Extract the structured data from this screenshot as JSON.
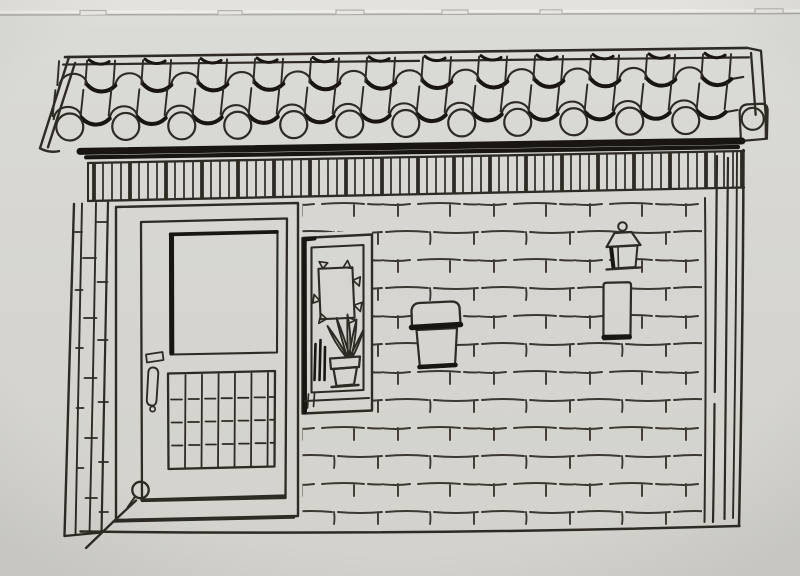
{
  "meta": {
    "type": "photograph of a hand-drawn ink sketch",
    "alt": "Black fineliner drawing on gray paper showing a small single-storey brick shopfront: a wavy pan-and-cover tile roof with round eave tile ends, a slatted fascia board, a framed entry door with a large window and slatted lower panel on the left, a tall display niche holding a clipped picture frame and a potted plant, and a hatched brick wall carrying a mailbox, a small lantern and a narrow plaque, with corner pillars on both sides."
  },
  "colors": {
    "paper_top": "#e3e2de",
    "paper": "#d8d7d3",
    "paper_low": "#d2d1cc",
    "edge_line": "#abaaa5",
    "ink": "#2e2a24",
    "ink_heavy": "#191612"
  },
  "scene": {
    "paper": {
      "label": "gray paper background"
    },
    "paper_edge": {
      "label": "paper top edge with small tear tabs",
      "tab_count": 6
    },
    "roof": {
      "label": "wavy pan-and-cover tile roof",
      "tile_columns": 12,
      "tile_rows": 2,
      "round_eave_tiles": 13
    },
    "eave_shadow": {
      "label": "heavy ink shadow band under the eaves"
    },
    "fascia": {
      "label": "slatted fascia board under the roof"
    },
    "brick_wall": {
      "label": "hand-hatched running-bond brick wall"
    },
    "left_pillar": {
      "label": "left corner pillar of stacked bricks"
    },
    "right_pillar": {
      "label": "right corner post drawn with long vertical strokes"
    },
    "door": {
      "label": "framed entry door",
      "window": {
        "label": "large upper window pane with heavy left edge"
      },
      "panel": {
        "label": "lower slatted panel",
        "slat_columns": 7
      },
      "handle": {
        "label": "vertical door handle"
      },
      "lock": {
        "label": "small lock plate"
      },
      "knob": {
        "label": "round knob at the door's bottom-left corner"
      }
    },
    "niche": {
      "label": "tall display niche beside the door",
      "picture_frame": {
        "label": "small picture frame with corner clips"
      },
      "plant": {
        "label": "potted plant with long leaves"
      },
      "sticks": {
        "label": "three dark stalks beside the pot"
      },
      "shelf": {
        "label": "display shelf board"
      }
    },
    "mailbox": {
      "label": "wall-mounted mailbox with hinged lid"
    },
    "lantern": {
      "label": "small wall lantern"
    },
    "plaque": {
      "label": "narrow wall plaque with dark base"
    }
  }
}
